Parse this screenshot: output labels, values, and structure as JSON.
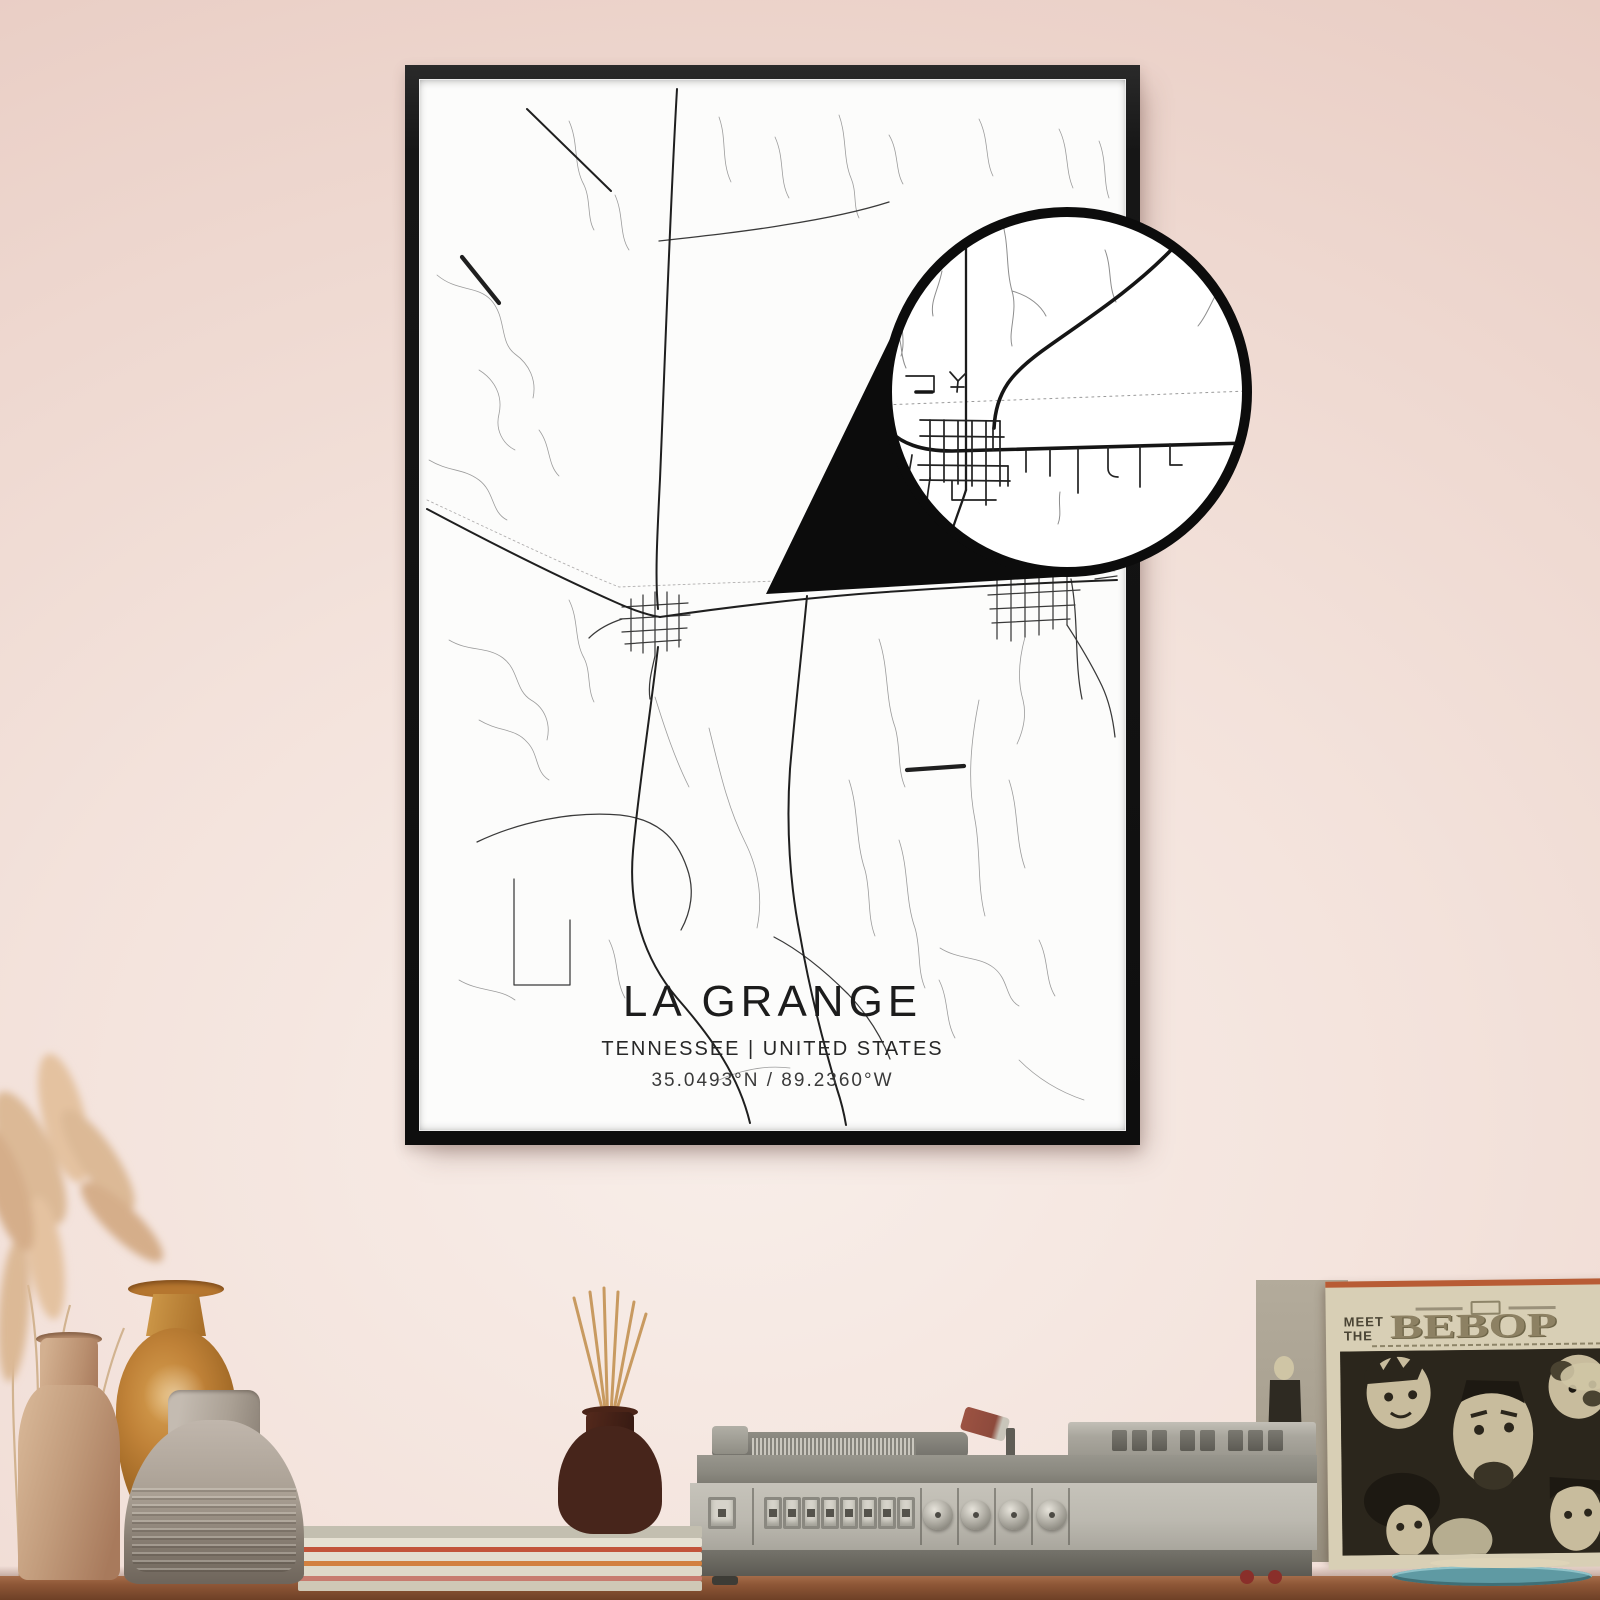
{
  "poster": {
    "title": "LA GRANGE",
    "subtitle": "TENNESSEE | UNITED STATES",
    "coordinates": "35.0493°N / 89.2360°W"
  },
  "record_sleeve": {
    "word1": "MEET",
    "word2": "THE",
    "word3": "BEBOP"
  },
  "colors": {
    "wall-top": "#e9cdc4",
    "wall-mid": "#f8eee9",
    "frame": "#161616",
    "paper": "#fcfcfb",
    "road-major": "#1f1f1f",
    "road-minor": "#9c9c9c",
    "ring": "#0c0c0c",
    "wood": "#8e5737",
    "player-body": "#bcb9b0",
    "sleeve-cream": "#d8cfb5",
    "sleeve-art": "#2b261c",
    "sleeve-face": "#c8bc9d",
    "vase-tan": "#c29c7c",
    "vase-orange": "#c08238",
    "vase-gray": "#aaa094",
    "diffuser": "#47251b",
    "reed": "#c89a60",
    "pampas": "#dcb996"
  }
}
